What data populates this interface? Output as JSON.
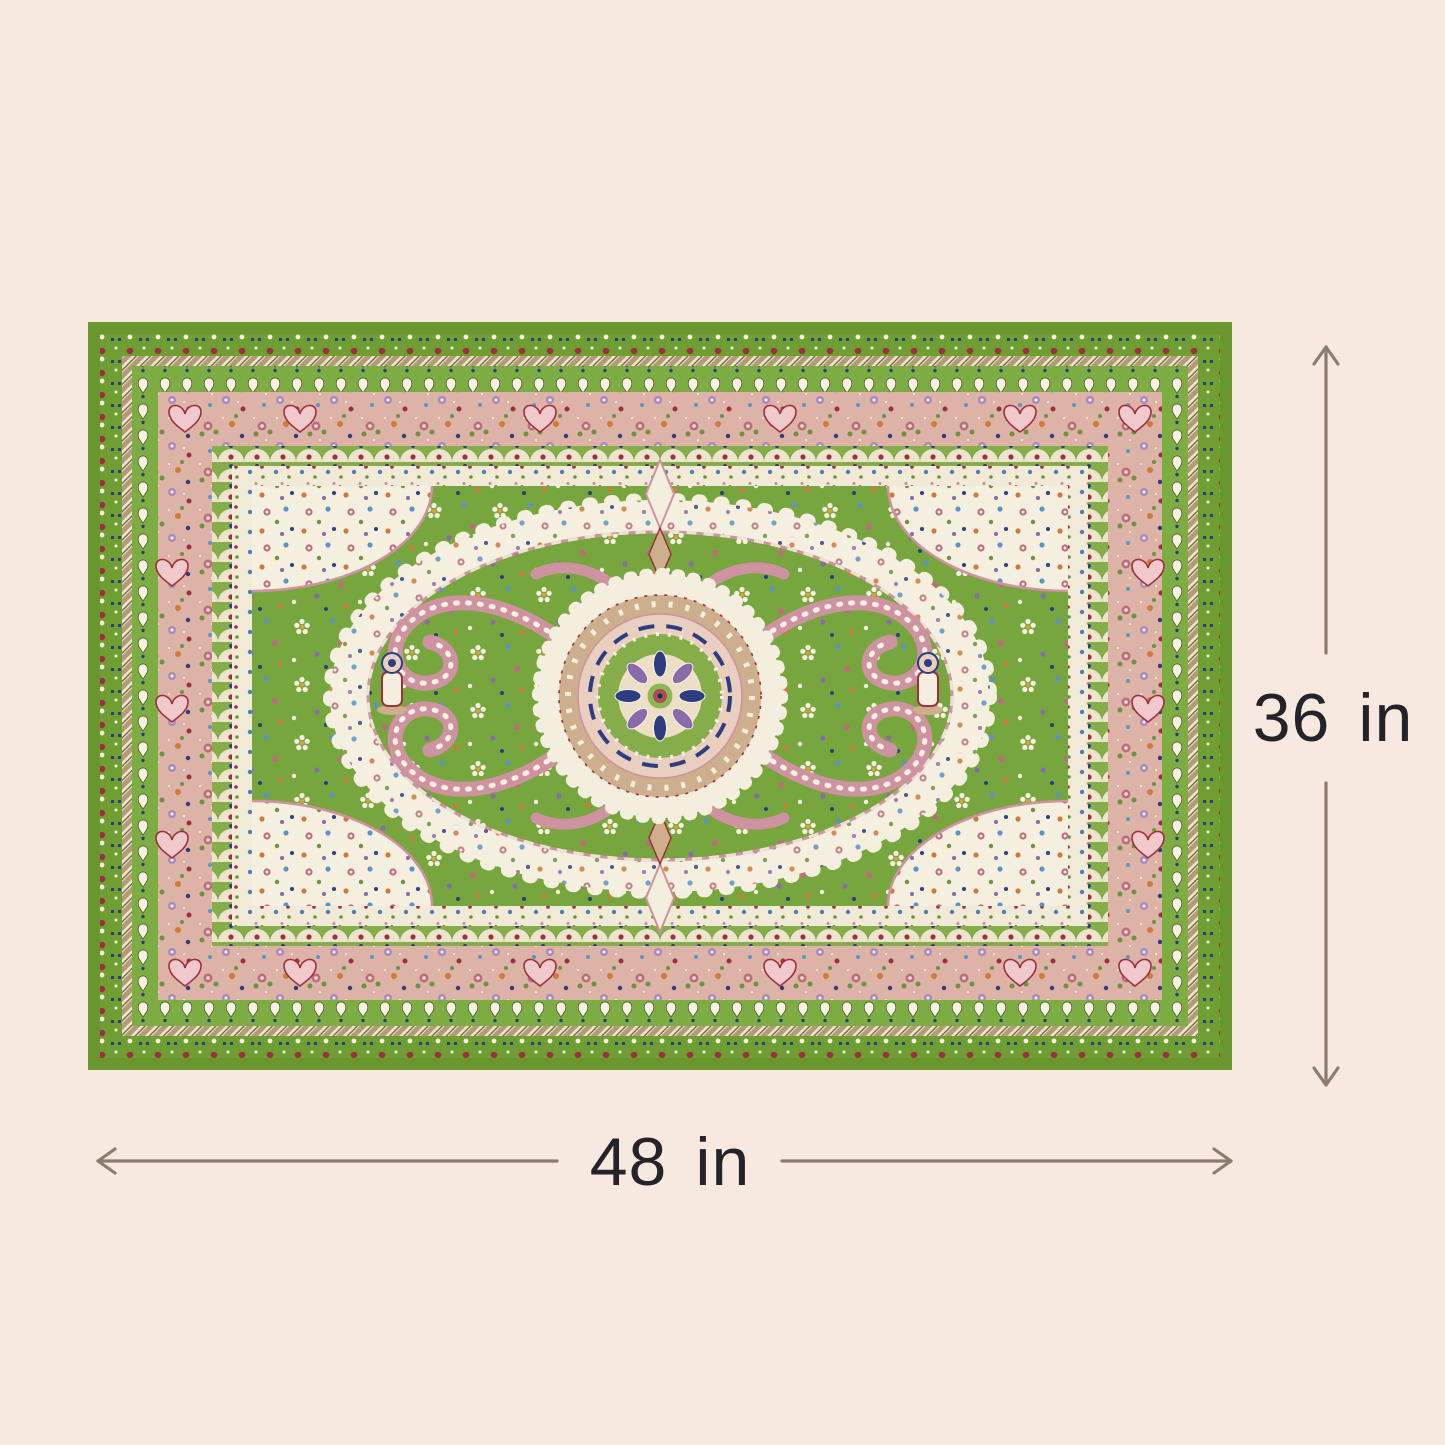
{
  "page": {
    "background_color": "#f8e9e0",
    "content": "product-dimension-diagram"
  },
  "product": {
    "name": "Green traditional oriental medallion area rug",
    "shown_as": "top-down rug photo with dimension arrows"
  },
  "dimensions": {
    "height": {
      "label": "36 in"
    },
    "width": {
      "label": "48 in"
    },
    "line_color": "#8d7b6e",
    "text_color": "#232329",
    "arrow_style": "open-chevron"
  },
  "rug_colors": {
    "edge_green": "#69962e",
    "field_green": "#77a63e",
    "band_pink": "#dcb3a6",
    "ivory": "#f3eedd",
    "tan": "#cdaf8d",
    "rose": "#ce92a0",
    "accent_red": "#9e2f3e",
    "accent_navy": "#2e3d80",
    "accent_blue": "#5e93c6",
    "accent_orange": "#cf7a3a"
  }
}
